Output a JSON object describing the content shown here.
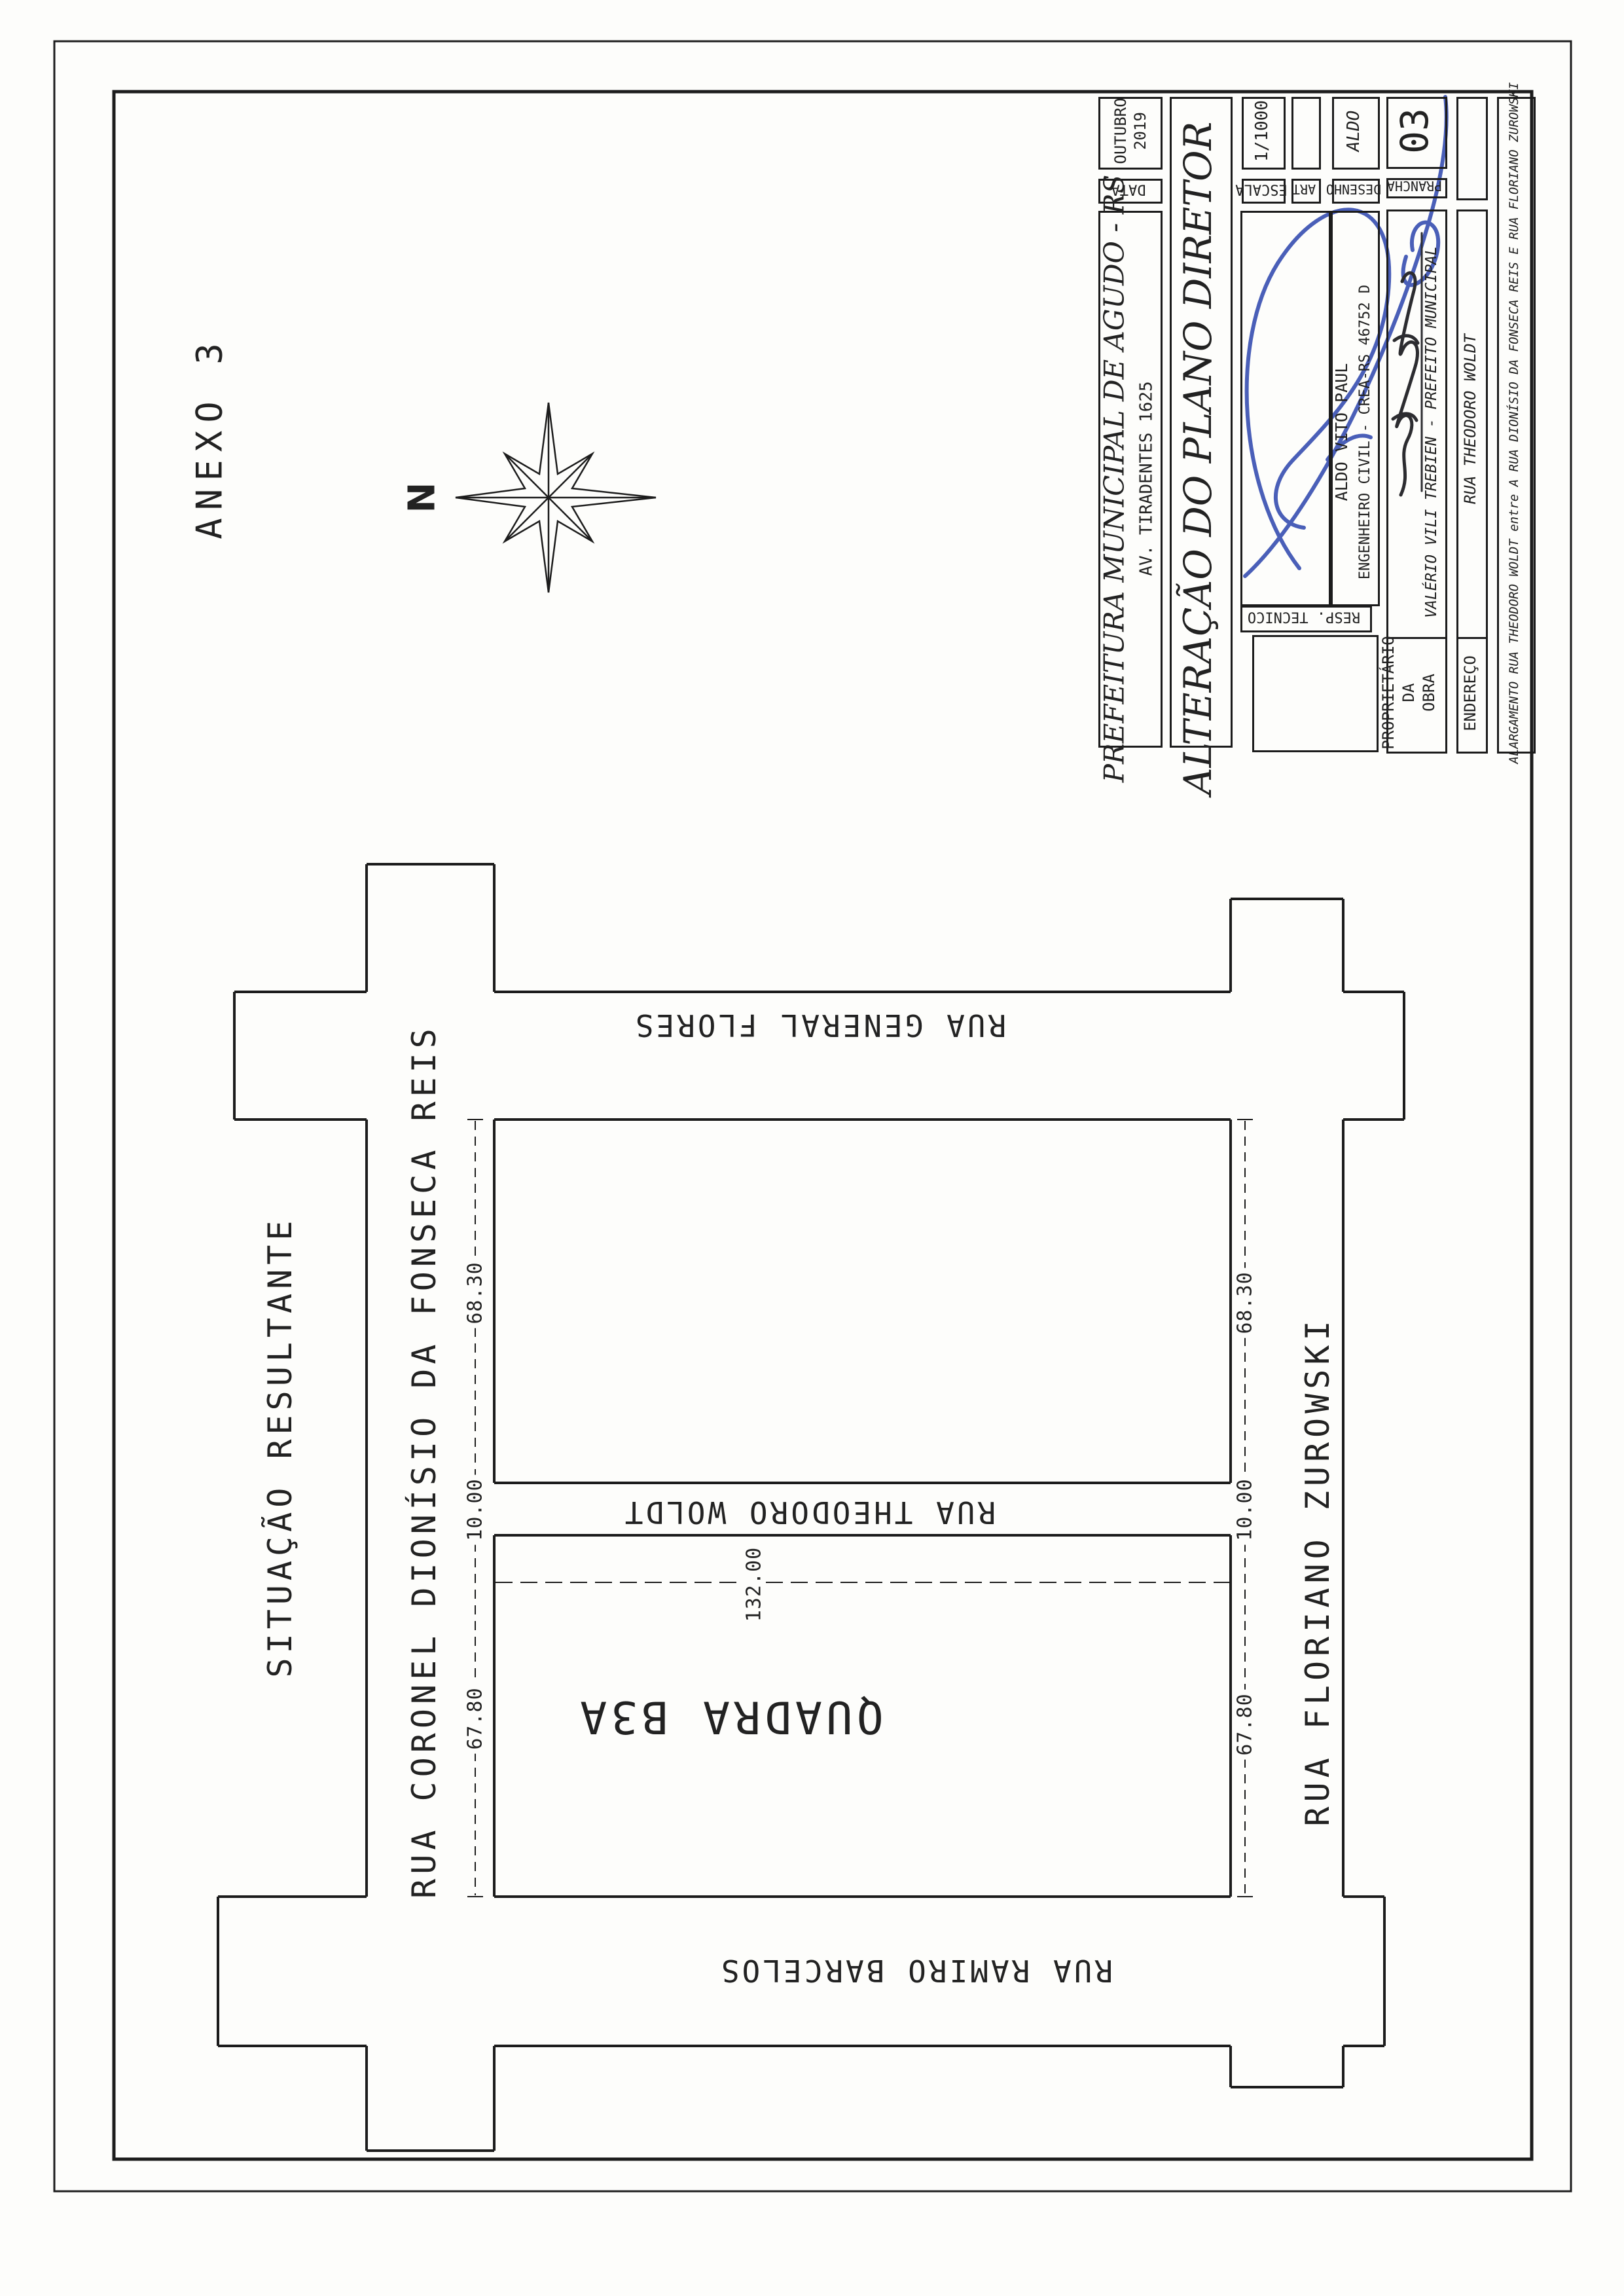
{
  "page": {
    "anexo": "ANEXO 3",
    "compass_n": "N",
    "situacao": "SITUAÇÃO RESULTANTE"
  },
  "streets": {
    "fonseca": "RUA CORONEL DIONÍSIO DA FONSECA REIS",
    "flores": "RUA GENERAL FLORES",
    "woldt": "RUA THEODORO WOLDT",
    "barcelos": "RUA RAMIRO BARCELOS",
    "zurowski": "RUA FLORIANO ZUROWSKI",
    "quadra": "QUADRA B3A"
  },
  "dimensions": {
    "left_block_top": "68.30",
    "left_street": "10.00",
    "left_block_bottom": "67.80",
    "right_block_top": "68.30",
    "right_street": "10.00",
    "right_block_bottom": "67.80",
    "block_width": "132.00"
  },
  "titleblock": {
    "org_line1": "PREFEITURA MUNICIPAL DE AGUDO - RS",
    "org_line2": "AV. TIRADENTES 1625",
    "data_label": "DATA",
    "data_value_l1": "OUTUBRO",
    "data_value_l2": "2019",
    "title": "ALTERAÇÃO DO PLANO DIRETOR",
    "escala_label": "ESCALA",
    "escala_value": "1/1000",
    "art_label": "ART",
    "art_value": "",
    "desenho_label": "DESENHO",
    "desenho_value": "ALDO",
    "prancha_label": "PRANCHA",
    "prancha_value": "03",
    "resp_label": "RESP. TECNICO",
    "resp_name": "ALDO VITO PAUL",
    "resp_title": "ENGENHEIRO CIVIL - CREA-RS 46752 D",
    "owner_label_l1": "PROPRIETÁRIO",
    "owner_label_l2": "DA",
    "owner_label_l3": "OBRA",
    "owner_name": "VALÉRIO VILI TREBIEN - PREFEITO MUNICIPAL",
    "endereco_label": "ENDEREÇO",
    "endereco_value": "RUA THEODORO WOLDT",
    "obra_descricao": "ALARGAMENTO RUA THEODORO WOLDT entre A RUA DIONÍSIO DA FONSECA REIS E RUA FLORIANO ZUROWSKI"
  }
}
